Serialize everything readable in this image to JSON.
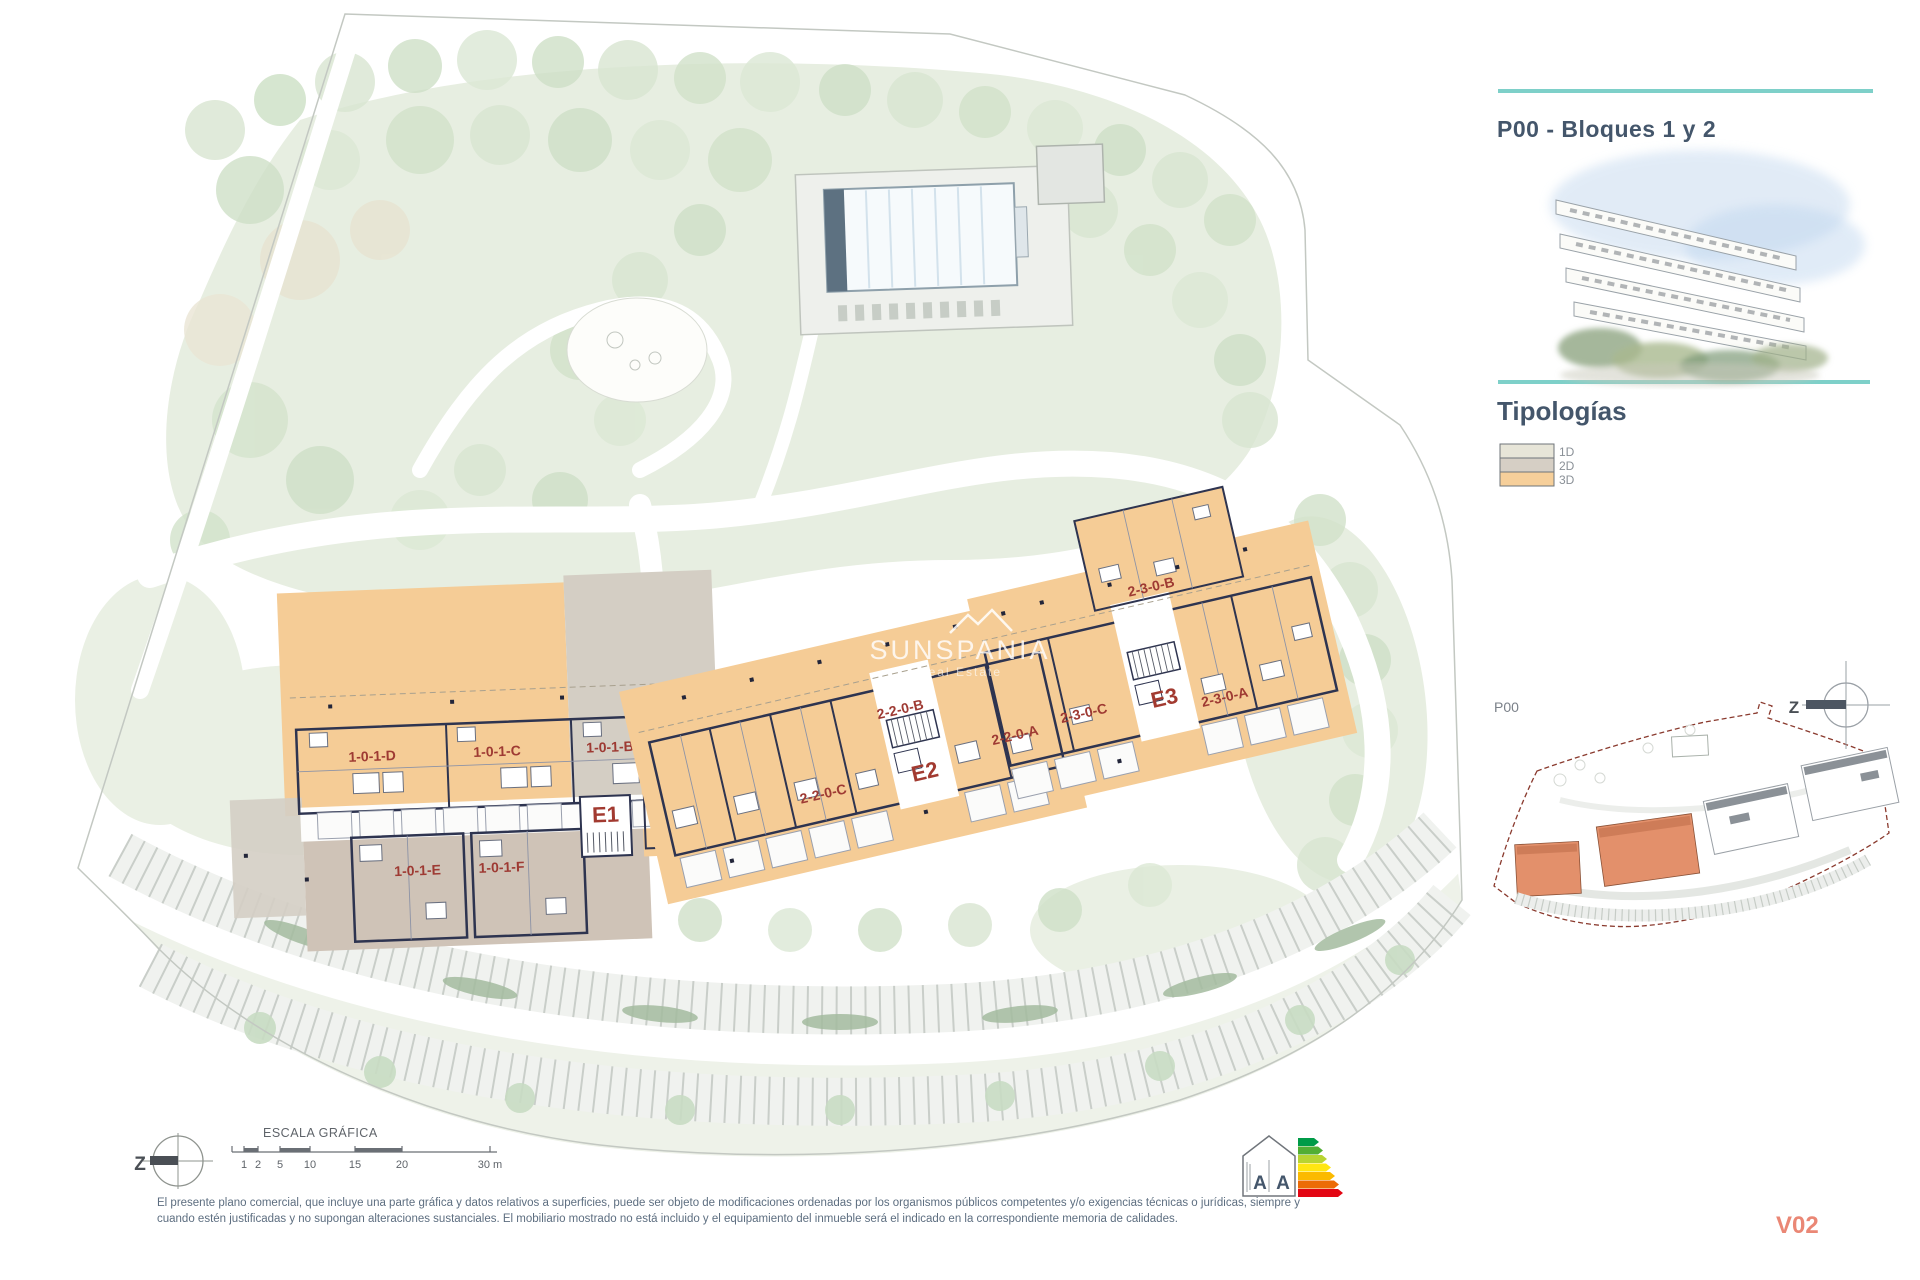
{
  "sheet": {
    "title": "P00 - Bloques 1 y 2",
    "section_tipologias": "Tipologías",
    "version": "V02",
    "accent_color": "#7ed0c9",
    "title_color": "#44566b"
  },
  "legend": {
    "items": [
      {
        "label": "1D",
        "color": "#e7e5d8"
      },
      {
        "label": "2D",
        "color": "#d6cfc5"
      },
      {
        "label": "3D",
        "color": "#f6cf9a"
      }
    ]
  },
  "minimap": {
    "label": "P00",
    "compass_letter": "Z",
    "highlight_color": "#e3906b",
    "boundary_color": "#8a3a2e"
  },
  "compass": {
    "letter": "Z"
  },
  "scalebar": {
    "title": "ESCALA GRÁFICA",
    "labels": [
      "1",
      "2",
      "5",
      "10",
      "15",
      "20",
      "30 m"
    ]
  },
  "watermark": {
    "brand": "SUNSPANIA",
    "tagline": "Real Estate"
  },
  "plan": {
    "label_color": "#9e3a33",
    "block1": {
      "core": "E1",
      "units": {
        "d": "1-0-1-D",
        "c": "1-0-1-C",
        "b": "1-0-1-B",
        "a": "1-0-1-A",
        "e": "1-0-1-E",
        "f": "1-0-1-F"
      }
    },
    "block2": {
      "core_e2": "E2",
      "core_e3": "E3",
      "units": {
        "u22c": "2-2-0-C",
        "u22b": "2-2-0-B",
        "u22a": "2-2-0-A",
        "u23c": "2-3-0-C",
        "u23b": "2-3-0-B",
        "u23a": "2-3-0-A"
      }
    }
  },
  "energy": {
    "letters": [
      "A",
      "A"
    ],
    "scale_colors": [
      "#009b48",
      "#52ae34",
      "#b8d432",
      "#ffe612",
      "#fbba00",
      "#ec6b06",
      "#e30613"
    ]
  },
  "disclaimer": {
    "line1": "El presente plano comercial, que incluye una parte gráfica y datos relativos a superficies, puede ser objeto de modificaciones ordenadas por los organismos públicos competentes y/o exigencias técnicas o jurídicas, siempre y",
    "line2": "cuando estén justificadas y no supongan alteraciones sustanciales. El mobiliario mostrado no está incluido y el equipamiento del inmueble será el indicado en la correspondiente memoria de calidades."
  }
}
